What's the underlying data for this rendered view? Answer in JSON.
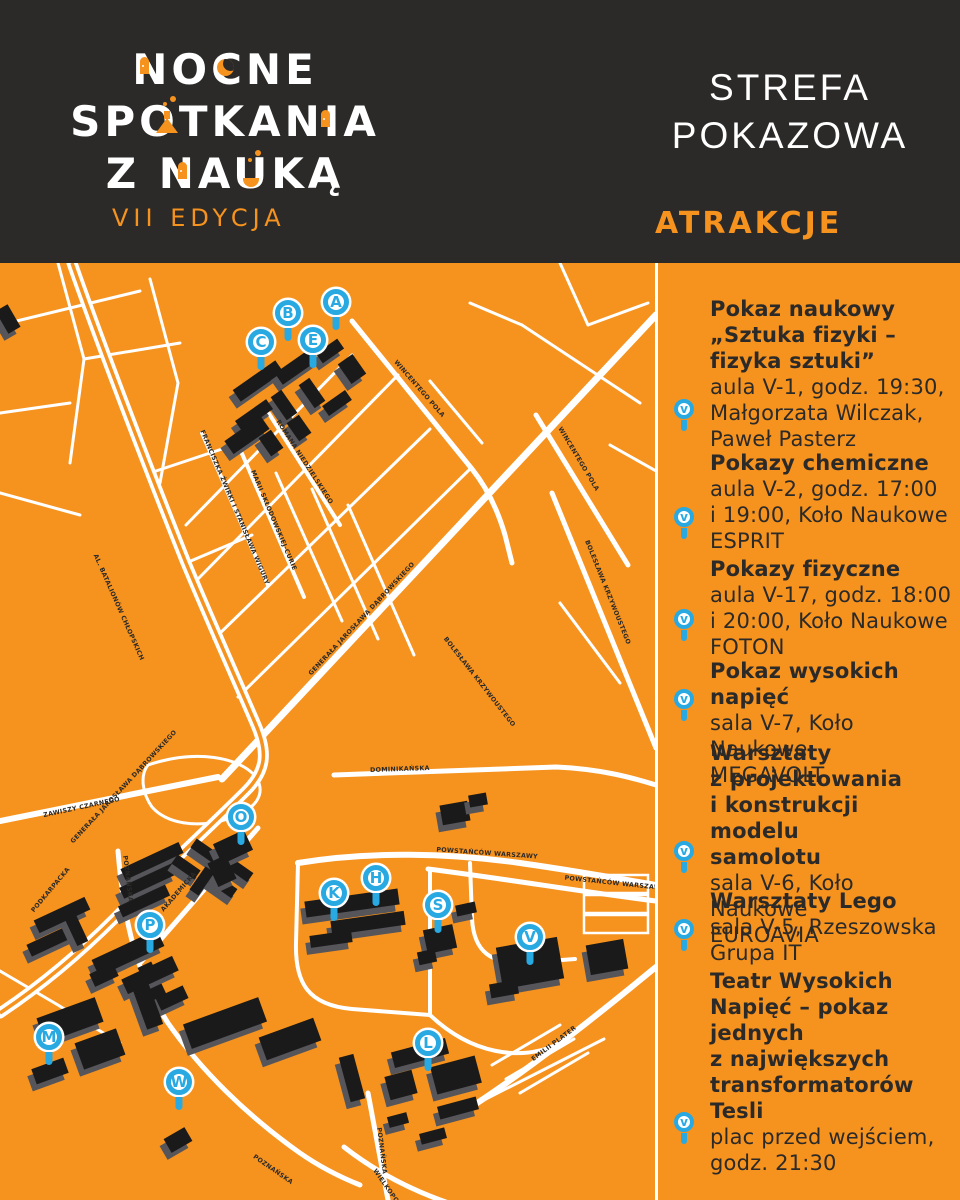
{
  "colors": {
    "orange": "#F6921E",
    "blue": "#29A9E1",
    "dark": "#2B2A28",
    "white": "#FFFFFF",
    "building_top": "#1A1A1A",
    "building_side": "#55555A"
  },
  "header": {
    "logo": {
      "line1": "NOCNE",
      "line2": "SPOTKANIA",
      "line3": "Z NAUKĄ",
      "edition": "VII EDYCJA"
    },
    "zone": {
      "line1": "STREFA",
      "line2": "POKAZOWA"
    },
    "attractions_heading": "ATRAKCJE"
  },
  "panel": {
    "sections": [
      {
        "title": "Pokaz naukowy\n„Sztuka fizyki –\nfizyka sztuki”",
        "details": "aula V-1, godz. 19:30,\nMałgorzata Wilczak,\nPaweł Pasterz",
        "pin_letter": "v"
      },
      {
        "title": "Pokazy chemiczne",
        "details": "aula V-2, godz. 17:00\ni 19:00, Koło Naukowe\nESPRIT",
        "pin_letter": "v"
      },
      {
        "title": "Pokazy fizyczne",
        "details": "aula V-17, godz. 18:00\ni 20:00, Koło Naukowe\nFOTON",
        "pin_letter": "v"
      },
      {
        "title": "Pokaz wysokich napięć",
        "details": "sala V-7, Koło Naukowe\nMEGAVOLT",
        "pin_letter": "v"
      },
      {
        "title": "Warsztaty\nz projektowania\ni konstrukcji modelu\nsamolotu",
        "details": "sala V-6, Koło Naukowe\nEUROAVIA",
        "pin_letter": "v"
      },
      {
        "title": "Warsztaty Lego",
        "details": "sala V-5, Rzeszowska\nGrupa IT",
        "pin_letter": "v"
      },
      {
        "title": "Teatr Wysokich\nNapięć – pokaz\njednych\nz największych\ntransformatorów\nTesli",
        "details": "plac przed wejściem,\ngodz. 21:30",
        "pin_letter": "v"
      }
    ]
  },
  "map": {
    "markers": [
      {
        "letter": "A",
        "x": 336,
        "y": 39
      },
      {
        "letter": "B",
        "x": 288,
        "y": 50
      },
      {
        "letter": "C",
        "x": 261,
        "y": 79
      },
      {
        "letter": "E",
        "x": 313,
        "y": 77
      },
      {
        "letter": "O",
        "x": 241,
        "y": 554
      },
      {
        "letter": "P",
        "x": 150,
        "y": 662
      },
      {
        "letter": "M",
        "x": 49,
        "y": 774
      },
      {
        "letter": "W",
        "x": 179,
        "y": 819
      },
      {
        "letter": "K",
        "x": 334,
        "y": 630
      },
      {
        "letter": "H",
        "x": 376,
        "y": 615
      },
      {
        "letter": "S",
        "x": 438,
        "y": 642
      },
      {
        "letter": "V",
        "x": 530,
        "y": 674
      },
      {
        "letter": "L",
        "x": 428,
        "y": 780
      }
    ],
    "streets": [
      "AL. BATALIONÓW CHŁOPSKICH",
      "GENERAŁA JAROSŁAWA DĄBROWSKIEGO",
      "GENERAŁA JAROSŁAWA DĄBROWSKIEGO",
      "ZAWISZY CZARNEGO",
      "PODKARPACKA",
      "POZNAŃSKA",
      "AKADEMICKA",
      "POWSTAŃCÓW WARSZAWY",
      "POWSTAŃCÓW WARSZAWY",
      "WINCENTEGO POLA",
      "WINCENTEGO POLA",
      "BOLESŁAWA KRZYWOUSTEGO",
      "BOLESŁAWA KRZYWOUSTEGO",
      "ROMANA NIEDZIELSKIEGO",
      "FRANCISZKA ŻWIRKI I STANISŁAWA WIGURY",
      "MARII SKŁODOWSKIEJ-CURIE",
      "DOMINIKAŃSKA",
      "POZNAŃSKA",
      "POZNAŃSKA",
      "WIELKOPOLSKA",
      "EMILII PLATER"
    ]
  }
}
